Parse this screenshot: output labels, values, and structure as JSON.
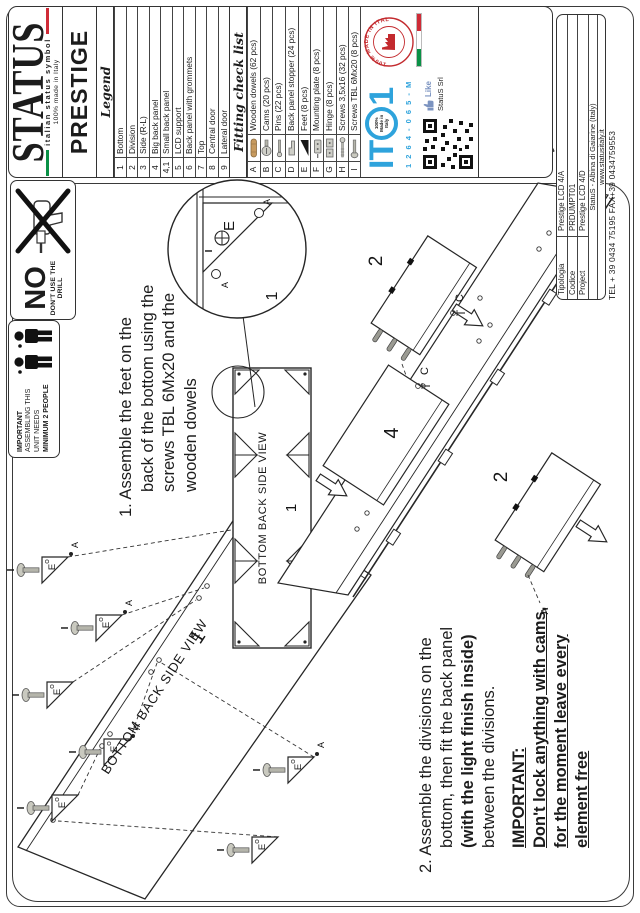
{
  "brand": {
    "name": "STATUS",
    "tagline": "italian status symbol",
    "made_in": "100% made in Italy"
  },
  "product": {
    "title": "PRESTIGE"
  },
  "legend": {
    "header": "Legend",
    "rows": [
      {
        "num": "1",
        "label": "Bottom"
      },
      {
        "num": "2",
        "label": "Division"
      },
      {
        "num": "3",
        "label": "Side (R-L)"
      },
      {
        "num": "4",
        "label": "Big back panel"
      },
      {
        "num": "4,1",
        "label": "Small back panel"
      },
      {
        "num": "5",
        "label": "LCD support"
      },
      {
        "num": "6",
        "label": "Back panel with grommets"
      },
      {
        "num": "7",
        "label": "Top"
      },
      {
        "num": "8",
        "label": "Central door"
      },
      {
        "num": "9",
        "label": "Lateral door"
      }
    ]
  },
  "fitting": {
    "header": "Fitting check list",
    "rows": [
      {
        "key": "A",
        "label": "Wooden dowels (62 pcs)",
        "icon": "wooden-dowel-icon"
      },
      {
        "key": "B",
        "label": "Cams (20 pcs)",
        "icon": "cam-icon"
      },
      {
        "key": "C",
        "label": "Pins (22 pcs)",
        "icon": "pin-icon"
      },
      {
        "key": "D",
        "label": "Back panel stopper (24 pcs)",
        "icon": "stopper-icon"
      },
      {
        "key": "E",
        "label": "Feet (8 pcs)",
        "icon": "foot-icon"
      },
      {
        "key": "F",
        "label": "Mounting plate (8 pcs)",
        "icon": "mounting-plate-icon"
      },
      {
        "key": "G",
        "label": "Hinge (8 pcs)",
        "icon": "hinge-icon"
      },
      {
        "key": "H",
        "label": "Screws 3,5x16 (32 pcs)",
        "icon": "screw-icon"
      },
      {
        "key": "I",
        "label": "Screws TBL 6Mx20 (8 pcs)",
        "icon": "tbl-screw-icon"
      }
    ]
  },
  "certification": {
    "stamp_text": "100% MADE IN ITALY",
    "logo_left": "IT",
    "logo_right": "1",
    "logo_inner1": "100%",
    "logo_inner2": "Made in",
    "logo_inner3": "Italy",
    "code": "1 2 6 4 - 0 6 5 - M",
    "like_label": "Like",
    "company": "StatuS Srl"
  },
  "footer": {
    "rows": [
      {
        "label": "Tipologia",
        "value": "Prestige LCD 4/A"
      },
      {
        "label": "Codice",
        "value": "PRDUMPT01"
      },
      {
        "label": "Project",
        "value": "Prestige LCD 4/D"
      }
    ],
    "address": "StatuS - Albina di Gaiarine (Italy)",
    "website": "www.statusitaly.it",
    "contact": "TEL + 39 0434 75195   FAX+39 0434759553"
  },
  "warnings": {
    "no_drill": {
      "word": "NO",
      "text": "DON'T USE THE DRILL"
    },
    "two_people": {
      "line1": "IMPORTANT",
      "line2": "ASSEMBLING THIS",
      "line3": "UNIT NEEDS",
      "line4": "MINIMUM 2 PEOPLE"
    }
  },
  "steps": {
    "step1": {
      "l1": "1. Assemble the feet on the",
      "l2": "back of the bottom using the",
      "l3": "screws TBL 6Mx20 and the",
      "l4": "wooden dowels"
    },
    "step2": {
      "l1": "2. Assemble the divisions on the",
      "l2": "bottom, then fit the back panel",
      "l3": "(with the light finish inside)",
      "l4": "between the divisions.",
      "i1": "IMPORTANT:",
      "i2": "Don't lock anything with cams,",
      "i3": "for the moment leave every",
      "i4": "element free"
    }
  },
  "diagram": {
    "view_label": "BOTTOM BACK SIDE VIEW",
    "bottom": "1",
    "division": "2",
    "back_panel": "4",
    "foot": "E",
    "dowel": "A",
    "pin": "C",
    "screw": "I"
  },
  "colors": {
    "ito_blue": "#2ea3dc",
    "stamp_red": "#c32a2e",
    "flag_green": "#0a9146",
    "flag_red": "#cf2b37",
    "dowel_tan": "#c79a5e"
  }
}
